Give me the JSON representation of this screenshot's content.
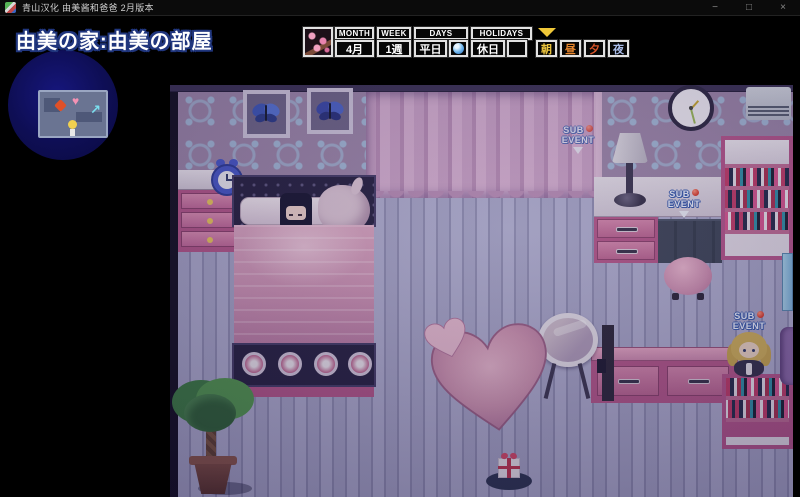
{
  "window": {
    "title": "青山汉化 由美酱和爸爸 2月版本",
    "controls": {
      "minimize": "−",
      "maximize": "□",
      "close": "×"
    }
  },
  "location": {
    "title": "由美の家:由美の部屋"
  },
  "hud": {
    "month": {
      "label": "MONTH",
      "value": "4月"
    },
    "week": {
      "label": "WEEK",
      "value": "1週"
    },
    "days": {
      "label": "DAYS",
      "value": "平日"
    },
    "holidays": {
      "label": "HOLIDAYS",
      "value": "休日"
    },
    "times": [
      {
        "label": "朝",
        "color": "#eec63e"
      },
      {
        "label": "昼",
        "color": "#e8872e"
      },
      {
        "label": "夕",
        "color": "#d95428"
      },
      {
        "label": "夜",
        "color": "#a9bce8"
      }
    ]
  },
  "markers": {
    "sub": {
      "line1": "SUB",
      "line2": "EVENT"
    },
    "dot_color": "#e04838"
  },
  "minimap_icons": {
    "heart": "♥",
    "arrow": "↗"
  },
  "colors": {
    "wallpaper": "#9c85a9",
    "curtain": "#c9a0c6",
    "floor": "#a7a5c8",
    "furniture_pink": "#c06b96",
    "hud_border": "#e2e2e2",
    "time_cursor": "#f0c838"
  }
}
